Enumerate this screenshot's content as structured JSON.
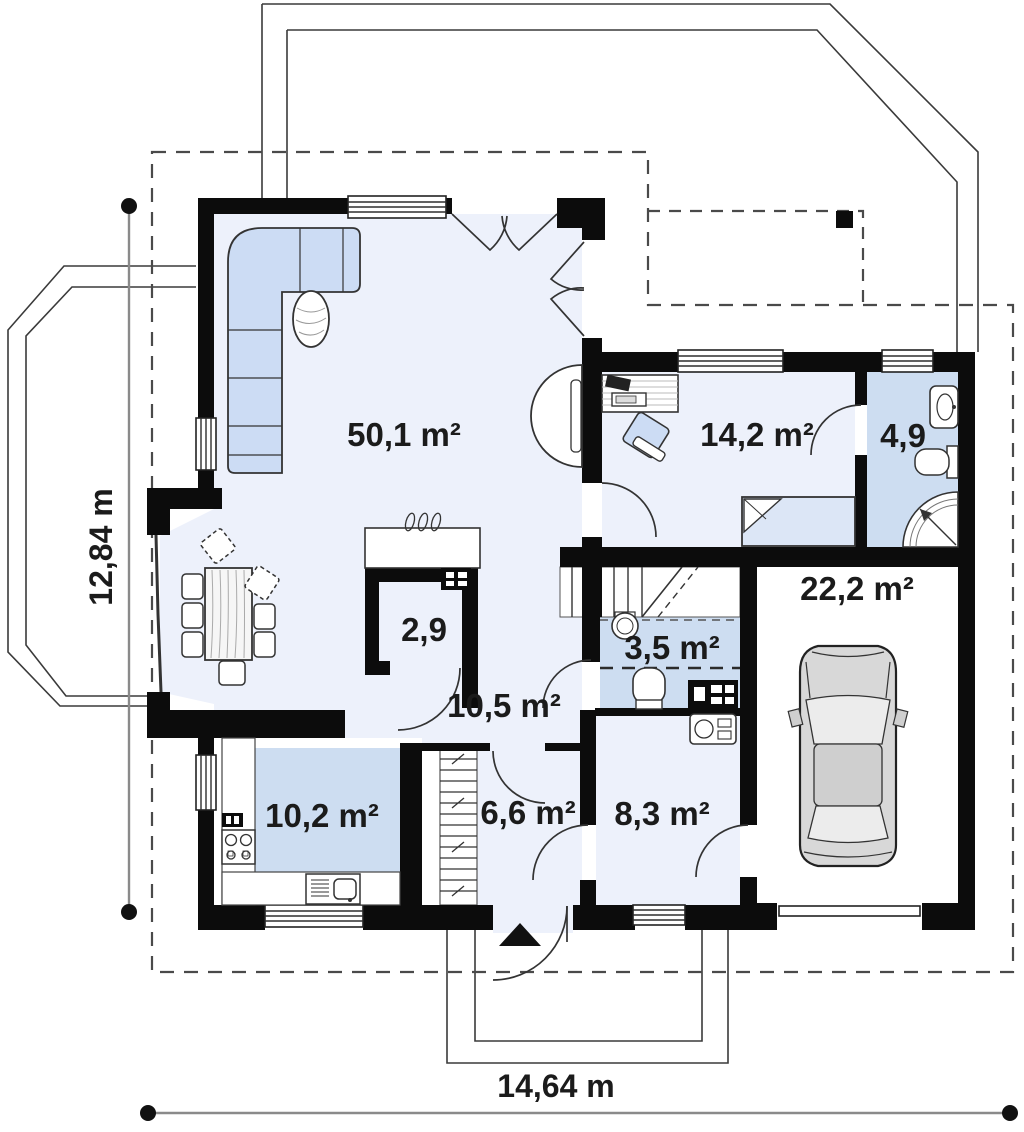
{
  "plan": {
    "rooms": {
      "living": {
        "label": "50,1 m²"
      },
      "bedroom": {
        "label": "14,2 m²"
      },
      "bathroom": {
        "label": "4,9"
      },
      "garage": {
        "label": "22,2 m²"
      },
      "pantry": {
        "label": "2,9"
      },
      "wc": {
        "label": "3,5 m²"
      },
      "hall": {
        "label": "10,5 m²"
      },
      "kitchen": {
        "label": "10,2 m²"
      },
      "entry": {
        "label": "6,6 m²"
      },
      "utility": {
        "label": "8,3 m²"
      }
    },
    "dimensions": {
      "height_label": "12,84 m",
      "width_label": "14,64 m"
    }
  },
  "colors": {
    "wall": "#0c0c0c",
    "floor-light": "#edf1fb",
    "floor-blue": "#cdddf1",
    "furn-blue": "#ccdcf4",
    "bed-blue": "#dce6f6",
    "car-gray": "#d8d8d8",
    "text": "#1b1b1b",
    "dash": "#4a4a4a",
    "dim": "#8a8a8a"
  }
}
